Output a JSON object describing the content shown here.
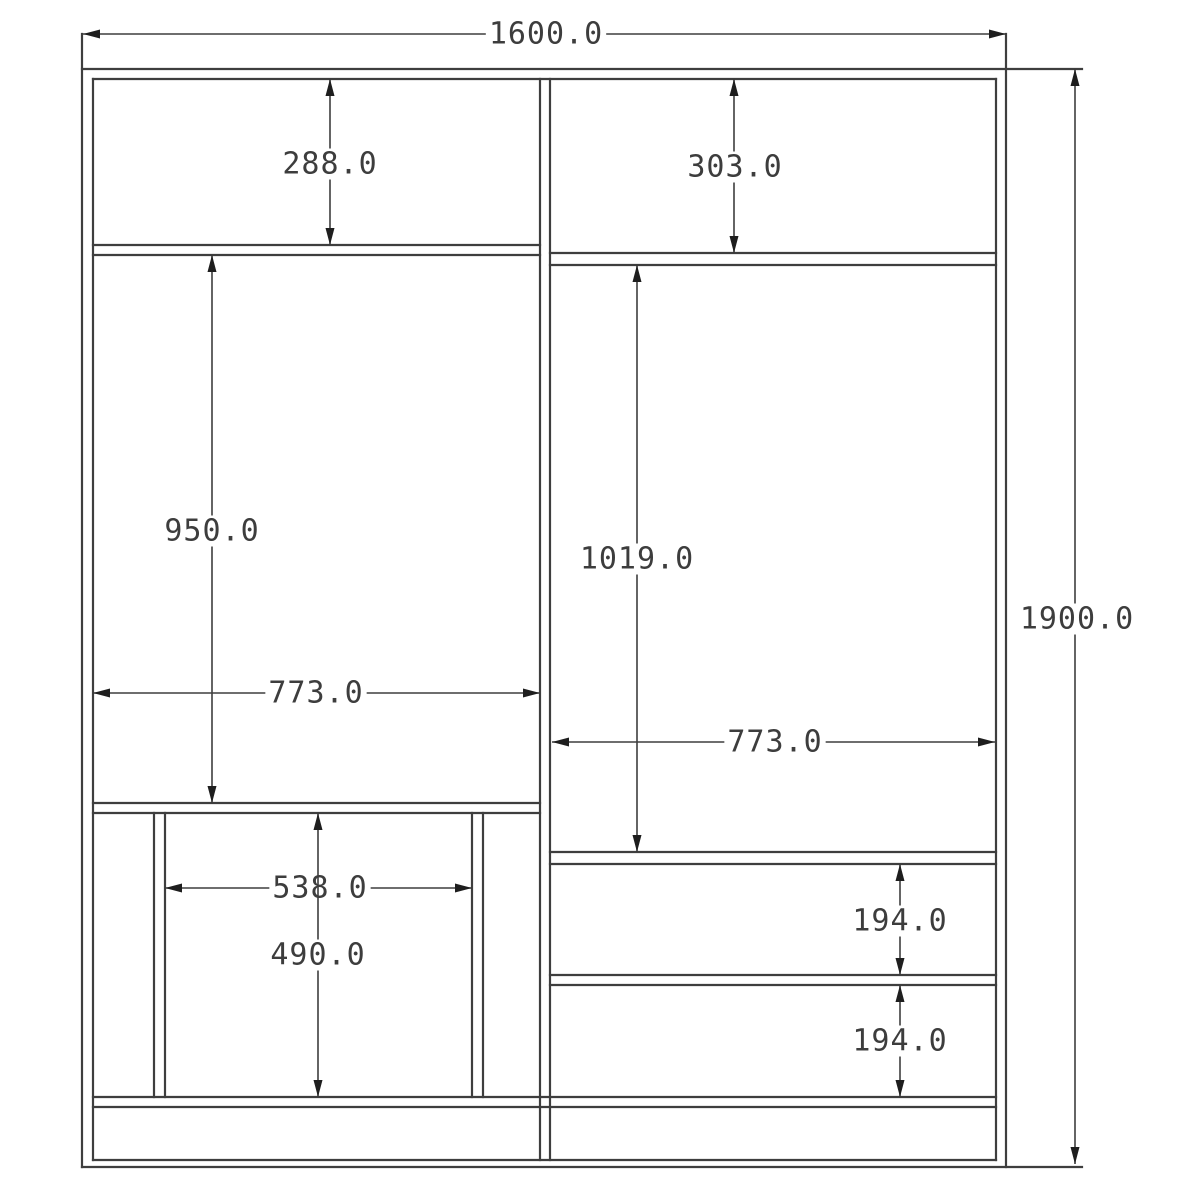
{
  "drawing": {
    "kind": "technical-elevation-drawing",
    "units_suffix": ".0",
    "canvas": {
      "width": 1200,
      "height": 1200,
      "background": "#ffffff"
    },
    "style": {
      "structure_color": "#3e3e3e",
      "structure_width": 2.2,
      "dimension_color": "#3e3e3e",
      "dimension_width": 1.6,
      "arrow_color": "#1e1e1e",
      "text_color": "#3d3d3d",
      "text_size": 30,
      "text_bg": "#ffffff",
      "arrow_length": 17,
      "arrow_halfwidth": 4.5
    },
    "structure": {
      "vertical_lines": [
        {
          "name": "left-panel-outer",
          "x": 82,
          "y1": 34,
          "y2": 1167
        },
        {
          "name": "left-panel-inner",
          "x": 93,
          "y1": 79,
          "y2": 1160
        },
        {
          "name": "center-divider-left",
          "x": 540,
          "y1": 79,
          "y2": 1160
        },
        {
          "name": "center-divider-right",
          "x": 550,
          "y1": 79,
          "y2": 1160
        },
        {
          "name": "right-panel-inner",
          "x": 996,
          "y1": 79,
          "y2": 1160
        },
        {
          "name": "right-panel-outer",
          "x": 1006,
          "y1": 34,
          "y2": 1167
        },
        {
          "name": "inner-box-left-outer",
          "x": 154,
          "y1": 813,
          "y2": 1097
        },
        {
          "name": "inner-box-left-inner",
          "x": 165,
          "y1": 813,
          "y2": 1097
        },
        {
          "name": "inner-box-right-inner",
          "x": 472,
          "y1": 813,
          "y2": 1097
        },
        {
          "name": "inner-box-right-outer",
          "x": 483,
          "y1": 813,
          "y2": 1097
        }
      ],
      "horizontal_lines": [
        {
          "name": "top-panel-outer",
          "y": 69,
          "x1": 82,
          "x2": 1082
        },
        {
          "name": "top-panel-inner",
          "y": 79,
          "x1": 93,
          "x2": 996
        },
        {
          "name": "left-top-shelf-upper",
          "y": 245,
          "x1": 93,
          "x2": 540
        },
        {
          "name": "left-top-shelf-lower",
          "y": 255,
          "x1": 93,
          "x2": 540
        },
        {
          "name": "right-top-shelf-upper",
          "y": 253,
          "x1": 550,
          "x2": 996
        },
        {
          "name": "right-top-shelf-lower",
          "y": 265,
          "x1": 550,
          "x2": 996
        },
        {
          "name": "left-mid-shelf-upper",
          "y": 803,
          "x1": 93,
          "x2": 540
        },
        {
          "name": "left-mid-shelf-lower",
          "y": 813,
          "x1": 93,
          "x2": 540
        },
        {
          "name": "right-mid-shelf-upper",
          "y": 852,
          "x1": 550,
          "x2": 996
        },
        {
          "name": "right-mid-shelf-lower",
          "y": 864,
          "x1": 550,
          "x2": 996
        },
        {
          "name": "drawer-divider-upper",
          "y": 975,
          "x1": 550,
          "x2": 996
        },
        {
          "name": "drawer-divider-lower",
          "y": 985,
          "x1": 550,
          "x2": 996
        },
        {
          "name": "bottom-shelf-upper",
          "y": 1097,
          "x1": 93,
          "x2": 996
        },
        {
          "name": "bottom-shelf-lower",
          "y": 1107,
          "x1": 93,
          "x2": 996
        },
        {
          "name": "base-panel-upper",
          "y": 1160,
          "x1": 93,
          "x2": 996
        },
        {
          "name": "base-panel-outer",
          "y": 1167,
          "x1": 82,
          "x2": 1082
        }
      ]
    },
    "dimensions": [
      {
        "name": "overall-width",
        "label": "1600.0",
        "dir": "h",
        "pos": 34,
        "from": 83,
        "to": 1006,
        "tx": 546,
        "ty": 35
      },
      {
        "name": "overall-height",
        "label": "1900.0",
        "dir": "v",
        "pos": 1075,
        "from": 69,
        "to": 1164,
        "tx": 1077,
        "ty": 620
      },
      {
        "name": "left-top-cavity",
        "label": "288.0",
        "dir": "v",
        "pos": 330,
        "from": 79,
        "to": 245,
        "tx": 330,
        "ty": 165
      },
      {
        "name": "right-top-cavity",
        "label": "303.0",
        "dir": "v",
        "pos": 734,
        "from": 79,
        "to": 253,
        "tx": 735,
        "ty": 168
      },
      {
        "name": "left-mid-cavity",
        "label": "950.0",
        "dir": "v",
        "pos": 212,
        "from": 255,
        "to": 803,
        "tx": 212,
        "ty": 532
      },
      {
        "name": "right-mid-cavity",
        "label": "1019.0",
        "dir": "v",
        "pos": 637,
        "from": 265,
        "to": 852,
        "tx": 637,
        "ty": 560
      },
      {
        "name": "left-cavity-width",
        "label": "773.0",
        "dir": "h",
        "pos": 693,
        "from": 93,
        "to": 540,
        "tx": 316,
        "ty": 694
      },
      {
        "name": "right-cavity-width",
        "label": "773.0",
        "dir": "h",
        "pos": 742,
        "from": 552,
        "to": 995,
        "tx": 775,
        "ty": 743
      },
      {
        "name": "inner-box-width",
        "label": "538.0",
        "dir": "h",
        "pos": 888,
        "from": 165,
        "to": 472,
        "tx": 320,
        "ty": 889
      },
      {
        "name": "inner-box-height",
        "label": "490.0",
        "dir": "v",
        "pos": 318,
        "from": 813,
        "to": 1097,
        "tx": 318,
        "ty": 956
      },
      {
        "name": "drawer-1-height",
        "label": "194.0",
        "dir": "v",
        "pos": 900,
        "from": 864,
        "to": 975,
        "tx": 900,
        "ty": 922
      },
      {
        "name": "drawer-2-height",
        "label": "194.0",
        "dir": "v",
        "pos": 900,
        "from": 985,
        "to": 1097,
        "tx": 900,
        "ty": 1042
      }
    ]
  }
}
